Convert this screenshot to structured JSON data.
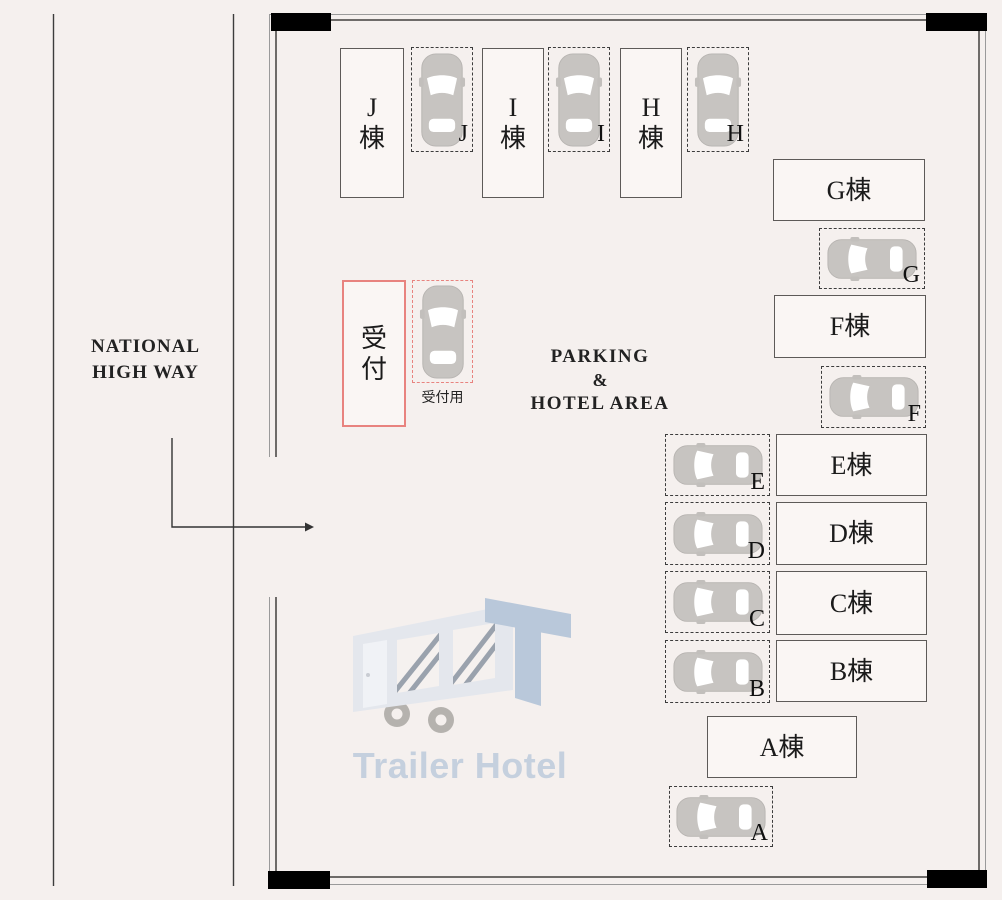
{
  "highway": {
    "label_line1": "NATIONAL",
    "label_line2": "HIGH WAY"
  },
  "area_label": {
    "line1": "PARKING",
    "line2": "&",
    "line3": "HOTEL AREA"
  },
  "reception": {
    "label_top": "受",
    "label_bottom": "付",
    "spot_caption": "受付用"
  },
  "buildings": {
    "j": {
      "label_top": "J",
      "label_bottom": "棟"
    },
    "i": {
      "label_top": "I",
      "label_bottom": "棟"
    },
    "h": {
      "label_top": "H",
      "label_bottom": "棟"
    },
    "g": {
      "label": "G棟"
    },
    "f": {
      "label": "F棟"
    },
    "e": {
      "label": "E棟"
    },
    "d": {
      "label": "D棟"
    },
    "c": {
      "label": "C棟"
    },
    "b": {
      "label": "B棟"
    },
    "a": {
      "label": "A棟"
    }
  },
  "spots": {
    "j": {
      "letter": "J"
    },
    "i": {
      "letter": "I"
    },
    "h": {
      "letter": "H"
    },
    "g": {
      "letter": "G"
    },
    "f": {
      "letter": "F"
    },
    "e": {
      "letter": "E"
    },
    "d": {
      "letter": "D"
    },
    "c": {
      "letter": "C"
    },
    "b": {
      "letter": "B"
    },
    "a": {
      "letter": "A"
    }
  },
  "watermark": {
    "text": "Trailer Hotel"
  },
  "colors": {
    "background": "#f5f0ee",
    "reception_red": "#e8837f",
    "frame_black": "#000000",
    "car_gray": "#c7c4c1",
    "watermark_blue": "#c5d0de"
  }
}
